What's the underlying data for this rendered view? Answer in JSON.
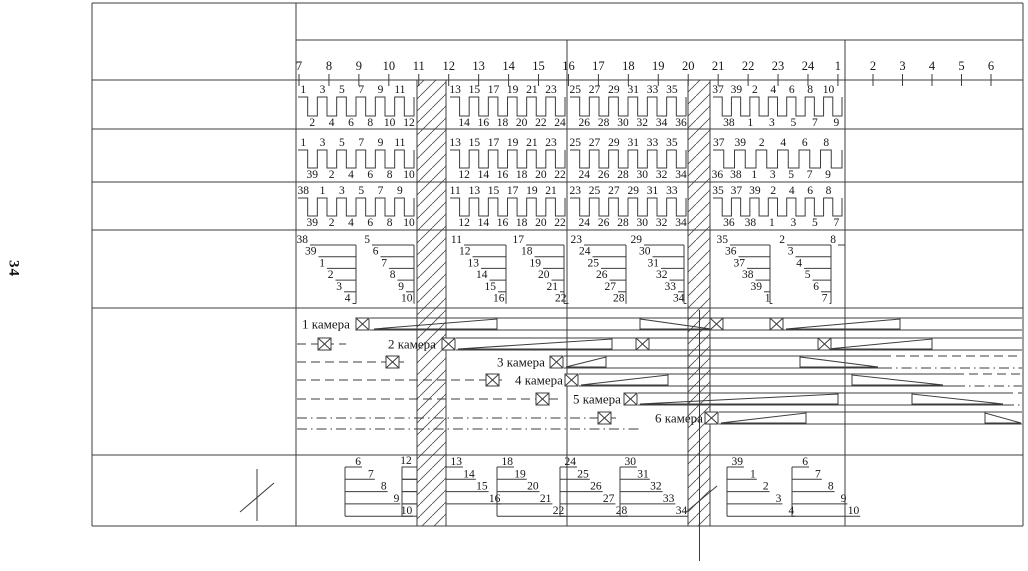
{
  "page_label": "34",
  "colors": {
    "line": "#3c3c3c",
    "text": "#161616",
    "hatch": "#555555",
    "background": "#ffffff"
  },
  "ruler": {
    "labels": [
      "7",
      "8",
      "9",
      "10",
      "11",
      "12",
      "13",
      "14",
      "15",
      "16",
      "17",
      "18",
      "19",
      "20",
      "21",
      "22",
      "23",
      "24",
      "1"
    ],
    "labels_right": [
      "2",
      "3",
      "4",
      "5",
      "6"
    ]
  },
  "comb_rows": [
    {
      "sections": [
        {
          "top": [
            "1",
            "3",
            "5",
            "7",
            "9",
            "11"
          ],
          "bottom": [
            "2",
            "4",
            "6",
            "8",
            "10",
            "12"
          ]
        },
        {
          "top": [
            "13",
            "15",
            "17",
            "19",
            "21",
            "23"
          ],
          "bottom": [
            "14",
            "16",
            "18",
            "20",
            "22",
            "24"
          ]
        },
        {
          "top": [
            "25",
            "27",
            "29",
            "31",
            "33",
            "35"
          ],
          "bottom": [
            "26",
            "28",
            "30",
            "32",
            "34",
            "36"
          ]
        },
        {
          "top": [
            "37",
            "39",
            "2",
            "4",
            "6",
            "8",
            "10"
          ],
          "bottom": [
            "38",
            "1",
            "3",
            "5",
            "7",
            "9"
          ]
        }
      ]
    },
    {
      "sections": [
        {
          "top": [
            "1",
            "3",
            "5",
            "7",
            "9",
            "11"
          ],
          "bottom": [
            "39",
            "2",
            "4",
            "6",
            "8",
            "10"
          ]
        },
        {
          "top": [
            "13",
            "15",
            "17",
            "19",
            "21",
            "23"
          ],
          "bottom": [
            "12",
            "14",
            "16",
            "18",
            "20",
            "22"
          ]
        },
        {
          "top": [
            "25",
            "27",
            "29",
            "31",
            "33",
            "35"
          ],
          "bottom": [
            "24",
            "26",
            "28",
            "30",
            "32",
            "34"
          ]
        },
        {
          "top": [
            "37",
            "39",
            "2",
            "4",
            "6",
            "8"
          ],
          "bottom": [
            "36",
            "38",
            "1",
            "3",
            "5",
            "7",
            "9"
          ]
        }
      ]
    },
    {
      "sections": [
        {
          "top": [
            "38",
            "1",
            "3",
            "5",
            "7",
            "9"
          ],
          "bottom": [
            "39",
            "2",
            "4",
            "6",
            "8",
            "10"
          ]
        },
        {
          "top": [
            "11",
            "13",
            "15",
            "17",
            "19",
            "21"
          ],
          "bottom": [
            "12",
            "14",
            "16",
            "18",
            "20",
            "22"
          ]
        },
        {
          "top": [
            "23",
            "25",
            "27",
            "29",
            "31",
            "33"
          ],
          "bottom": [
            "24",
            "26",
            "28",
            "30",
            "32",
            "34"
          ]
        },
        {
          "top": [
            "35",
            "37",
            "39",
            "2",
            "4",
            "6",
            "8"
          ],
          "bottom": [
            "36",
            "38",
            "1",
            "3",
            "5",
            "7"
          ]
        }
      ]
    }
  ],
  "fan_groups": [
    {
      "nums": [
        "38",
        "39",
        "1",
        "2",
        "3",
        "4"
      ]
    },
    {
      "nums": [
        "5",
        "6",
        "7",
        "8",
        "9",
        "10"
      ]
    },
    {
      "nums": [
        "11",
        "12",
        "13",
        "14",
        "15",
        "16"
      ]
    },
    {
      "nums": [
        "17",
        "18",
        "19",
        "20",
        "21",
        "22"
      ]
    },
    {
      "nums": [
        "23",
        "24",
        "25",
        "26",
        "27",
        "28"
      ]
    },
    {
      "nums": [
        "29",
        "30",
        "31",
        "32",
        "33",
        "34"
      ]
    },
    {
      "nums": [
        "35",
        "36",
        "37",
        "38",
        "39",
        "1"
      ]
    },
    {
      "nums": [
        "2",
        "3",
        "4",
        "5",
        "6",
        "7"
      ]
    },
    {
      "nums": [
        "8"
      ]
    }
  ],
  "ladder_label": "12",
  "bottom_groups": [
    {
      "nums": [
        "6",
        "7",
        "8",
        "9",
        "10"
      ]
    },
    {
      "nums": [
        "13",
        "14",
        "15",
        "16"
      ]
    },
    {
      "nums": [
        "18",
        "19",
        "20",
        "21",
        "22"
      ]
    },
    {
      "nums": [
        "24",
        "25",
        "26",
        "27",
        "28"
      ]
    },
    {
      "nums": [
        "30",
        "31",
        "32",
        "33",
        "34"
      ]
    },
    {
      "nums": [
        "39",
        "1",
        "2",
        "3",
        "4"
      ]
    },
    {
      "nums": [
        "6",
        "7",
        "8",
        "9",
        "10"
      ]
    }
  ],
  "chambers": [
    {
      "label": "1 камера"
    },
    {
      "label": "2 камера"
    },
    {
      "label": "3 камера"
    },
    {
      "label": "4 камера"
    },
    {
      "label": "5 камера"
    },
    {
      "label": "6 камера"
    }
  ]
}
